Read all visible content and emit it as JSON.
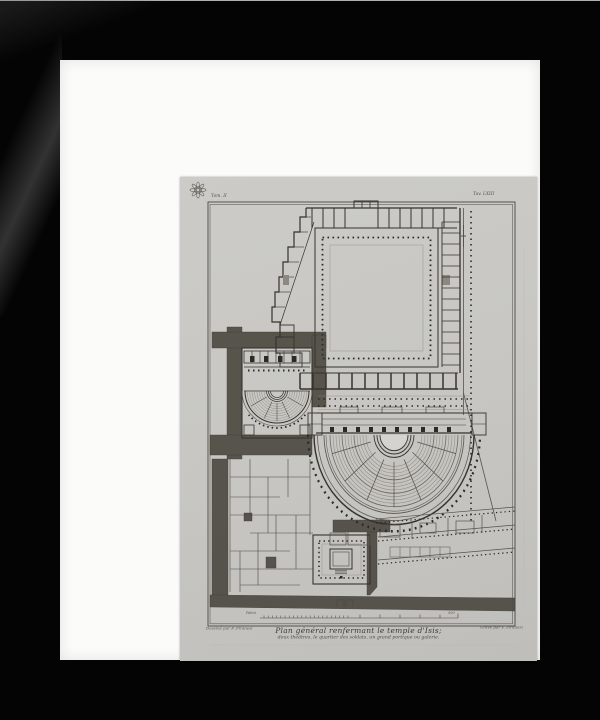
{
  "artwork": {
    "plate_mark_left": "Tom. II",
    "plate_mark_right": "Tav. LXIII",
    "title_line1": "Plan général renfermant le temple d'Isis;",
    "title_line2": "deux théâtres, le quartier des soldats, un grand portique ou galerie.",
    "credit_left": "Dessiné par F. Piranesi",
    "credit_right": "Gravé par F. Piranesi",
    "scale_label_left": "Palmi",
    "scale_label_right": "500"
  },
  "colors": {
    "frame": "#040404",
    "mat": "#fbfbfa",
    "paper": "#c8c7c3",
    "ink_wall": "#35332d",
    "ink_thin": "#6e6b63",
    "street_fill": "#514e46",
    "seat_line": "#8b887e"
  }
}
